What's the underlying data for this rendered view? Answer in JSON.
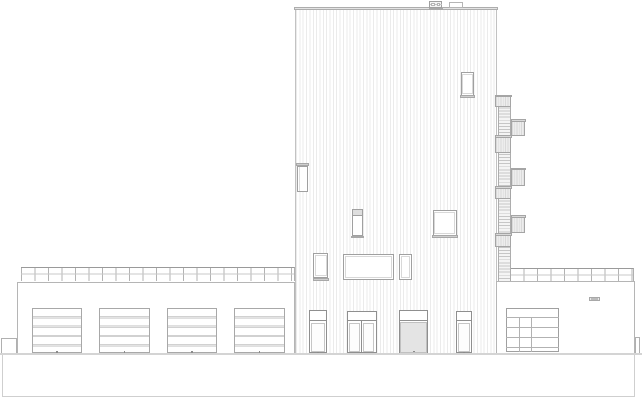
{
  "canvas": {
    "width": 644,
    "height": 400,
    "background": "#ffffff"
  },
  "palette": {
    "frame_dark": "#8f8f8f",
    "frame_mid": "#a8a8a8",
    "line_light": "#c9c9c9",
    "cladding_line": "#ebebeb",
    "panel_fill": "#ededed",
    "ground_line": "#d4d4d4",
    "basement_line": "#cfcfcf",
    "paper": "#ffffff"
  },
  "elements": [
    {
      "name": "tower-facade",
      "cls": "cladding",
      "x": 294.5,
      "y": 10,
      "w": 202.5,
      "h": 343.5
    },
    {
      "name": "tower-parapet-cap",
      "cls": "cap",
      "x": 294,
      "y": 6.6,
      "w": 203.5,
      "h": 3.9
    },
    {
      "name": "roof-unit-base",
      "cls": "sill",
      "x": 428.5,
      "y": 7.6,
      "w": 14.5,
      "h": 2
    },
    {
      "name": "roof-unit",
      "cls": "unit",
      "x": 429,
      "y": 1,
      "w": 13,
      "h": 6.6
    },
    {
      "name": "roof-unit-line",
      "cls": "hline",
      "x": 429.5,
      "y": 3.9,
      "w": 12,
      "h": 0.8
    },
    {
      "name": "roof-unit-box-1",
      "cls": "unit-in",
      "x": 431.3,
      "y": 2.6,
      "w": 4.2,
      "h": 3
    },
    {
      "name": "roof-unit-box-2",
      "cls": "unit-in",
      "x": 436.6,
      "y": 2.6,
      "w": 3.4,
      "h": 3
    },
    {
      "name": "roof-box",
      "cls": "unit2",
      "x": 448.6,
      "y": 2,
      "w": 14.8,
      "h": 5.6
    },
    {
      "name": "window-upper",
      "cls": "win",
      "x": 460.7,
      "y": 72.3,
      "w": 13.6,
      "h": 24
    },
    {
      "name": "window-upper-inner",
      "cls": "win-inner",
      "x": 462.2,
      "y": 74,
      "w": 10.6,
      "h": 19.5
    },
    {
      "name": "window-upper-sill",
      "cls": "sill",
      "x": 460,
      "y": 95.3,
      "w": 15,
      "h": 2.8
    },
    {
      "name": "side-door-canopy",
      "cls": "sill",
      "x": 295.8,
      "y": 163.2,
      "w": 13.4,
      "h": 2.9
    },
    {
      "name": "side-door",
      "cls": "win",
      "x": 297.4,
      "y": 166.1,
      "w": 11,
      "h": 25.6
    },
    {
      "name": "side-door-jamb",
      "cls": "fill-mid",
      "x": 298.6,
      "y": 167.2,
      "w": 1.8,
      "h": 23.4
    },
    {
      "name": "window-mid-small",
      "cls": "win",
      "x": 351.7,
      "y": 209,
      "w": 11.6,
      "h": 26.7
    },
    {
      "name": "window-mid-small-band",
      "cls": "band",
      "x": 352.6,
      "y": 209.9,
      "w": 9.8,
      "h": 6.4
    },
    {
      "name": "window-mid-small-sill",
      "cls": "sill",
      "x": 351,
      "y": 235.5,
      "w": 13,
      "h": 2.6
    },
    {
      "name": "window-mid-square",
      "cls": "win",
      "x": 432.7,
      "y": 210,
      "w": 24,
      "h": 25.5
    },
    {
      "name": "window-mid-square-inner",
      "cls": "win-inner",
      "x": 434.4,
      "y": 211.7,
      "w": 20.6,
      "h": 22
    },
    {
      "name": "window-mid-square-sill",
      "cls": "sill",
      "x": 432,
      "y": 235.3,
      "w": 25.6,
      "h": 2.8
    },
    {
      "name": "window-l1",
      "cls": "win",
      "x": 313.3,
      "y": 253.3,
      "w": 15,
      "h": 24.5
    },
    {
      "name": "window-l1-inner",
      "cls": "win-inner",
      "x": 315,
      "y": 255,
      "w": 11.6,
      "h": 21
    },
    {
      "name": "window-l1-sill",
      "cls": "sill",
      "x": 312.6,
      "y": 277.6,
      "w": 16.4,
      "h": 3
    },
    {
      "name": "window-wide",
      "cls": "win",
      "x": 342.7,
      "y": 254.3,
      "w": 51.6,
      "h": 25.7
    },
    {
      "name": "window-wide-inner",
      "cls": "win-inner",
      "x": 344.6,
      "y": 256.2,
      "w": 47.8,
      "h": 21.9
    },
    {
      "name": "window-l3",
      "cls": "win",
      "x": 399.3,
      "y": 254.3,
      "w": 12.4,
      "h": 25.7
    },
    {
      "name": "window-l3-inner",
      "cls": "win-inner",
      "x": 401,
      "y": 256,
      "w": 9,
      "h": 22.3
    },
    {
      "name": "entry-door-1",
      "cls": "door",
      "x": 309.3,
      "y": 310,
      "w": 17.4,
      "h": 43.4
    },
    {
      "name": "entry-door-1-transom",
      "cls": "dline",
      "x": 309.3,
      "y": 319.8,
      "w": 17.4,
      "h": 1.1
    },
    {
      "name": "entry-door-1-leaf",
      "cls": "leaf",
      "x": 311.2,
      "y": 322.5,
      "w": 13.6,
      "h": 29
    },
    {
      "name": "entry-door-1-handle",
      "cls": "dot",
      "x": 317.3,
      "y": 351.6,
      "w": 1.7,
      "h": 1.5
    },
    {
      "name": "entry-door-2",
      "cls": "door",
      "x": 346.7,
      "y": 310.7,
      "w": 30,
      "h": 42.7
    },
    {
      "name": "entry-door-2-transom",
      "cls": "dline",
      "x": 346.7,
      "y": 320.2,
      "w": 30,
      "h": 1.1
    },
    {
      "name": "entry-door-2-leaf-left",
      "cls": "leaf",
      "x": 348.6,
      "y": 322.6,
      "w": 11.2,
      "h": 29.2
    },
    {
      "name": "entry-door-2-leaf-right",
      "cls": "leaf",
      "x": 363.2,
      "y": 322.6,
      "w": 11.2,
      "h": 29.2
    },
    {
      "name": "entry-door-2-mullion",
      "cls": "dline",
      "x": 360.9,
      "y": 321.3,
      "w": 1.2,
      "h": 32.1
    },
    {
      "name": "entry-door-2-handle",
      "cls": "dot",
      "x": 360.3,
      "y": 351.6,
      "w": 1.7,
      "h": 1.5
    },
    {
      "name": "service-door",
      "cls": "door",
      "x": 399.3,
      "y": 310,
      "w": 29,
      "h": 43.4
    },
    {
      "name": "service-door-transom",
      "cls": "dline",
      "x": 399.3,
      "y": 319.8,
      "w": 29,
      "h": 1.1
    },
    {
      "name": "service-door-panel",
      "cls": "dfill",
      "x": 400.4,
      "y": 321.5,
      "w": 26.8,
      "h": 31.2
    },
    {
      "name": "service-door-handle",
      "cls": "dot",
      "x": 412.7,
      "y": 350.9,
      "w": 2,
      "h": 1.6
    },
    {
      "name": "entry-door-3",
      "cls": "door",
      "x": 455.7,
      "y": 310.7,
      "w": 16,
      "h": 42.7
    },
    {
      "name": "entry-door-3-transom",
      "cls": "dline",
      "x": 455.7,
      "y": 320.2,
      "w": 16,
      "h": 1.1
    },
    {
      "name": "entry-door-3-leaf",
      "cls": "leaf",
      "x": 457.5,
      "y": 322.5,
      "w": 12.4,
      "h": 29.2
    },
    {
      "name": "entry-door-3-handle",
      "cls": "dot",
      "x": 462.9,
      "y": 351.6,
      "w": 1.7,
      "h": 1.5
    },
    {
      "name": "left-wing-facade",
      "cls": "wing",
      "x": 17.3,
      "y": 281.5,
      "w": 278,
      "h": 71.8
    },
    {
      "name": "left-wing-roof-railing",
      "cls": "railing",
      "x": 20.7,
      "y": 267.2,
      "w": 274.6,
      "h": 14.3
    },
    {
      "name": "garage-door-1",
      "cls": "gdoor",
      "x": 31.7,
      "y": 307.7,
      "w": 50.4,
      "h": 45.2
    },
    {
      "name": "garage-door-2",
      "cls": "gdoor",
      "x": 99.3,
      "y": 307.7,
      "w": 50.4,
      "h": 45.2
    },
    {
      "name": "garage-door-3",
      "cls": "gdoor",
      "x": 166.8,
      "y": 307.7,
      "w": 50.4,
      "h": 45.2
    },
    {
      "name": "garage-door-4",
      "cls": "gdoor",
      "x": 234.2,
      "y": 307.7,
      "w": 50.4,
      "h": 45.2
    },
    {
      "name": "garage-door-1-handle",
      "cls": "dot",
      "x": 56.2,
      "y": 351.3,
      "w": 1.7,
      "h": 1.5
    },
    {
      "name": "garage-door-2-handle",
      "cls": "dot",
      "x": 123.7,
      "y": 351.3,
      "w": 1.7,
      "h": 1.5
    },
    {
      "name": "garage-door-3-handle",
      "cls": "dot",
      "x": 191.2,
      "y": 351.3,
      "w": 1.7,
      "h": 1.5
    },
    {
      "name": "garage-door-4-handle",
      "cls": "dot",
      "x": 258.6,
      "y": 351.3,
      "w": 1.7,
      "h": 1.5
    },
    {
      "name": "left-ramp-wall",
      "cls": "outline",
      "x": 0.7,
      "y": 338,
      "w": 16.6,
      "h": 15
    },
    {
      "name": "right-wing-facade",
      "cls": "wing",
      "x": 496.2,
      "y": 281,
      "w": 138.6,
      "h": 72.3
    },
    {
      "name": "right-wing-roof-railing",
      "cls": "railing",
      "x": 509.8,
      "y": 268,
      "w": 124.4,
      "h": 13
    },
    {
      "name": "glazed-door",
      "cls": "door2",
      "x": 506,
      "y": 307.7,
      "w": 53,
      "h": 44.6
    },
    {
      "name": "glazed-door-transom-line",
      "cls": "dline-l",
      "x": 506,
      "y": 317.4,
      "w": 53,
      "h": 1
    },
    {
      "name": "glazed-door-rail-1",
      "cls": "dline-l",
      "x": 506,
      "y": 327.3,
      "w": 53,
      "h": 0.9
    },
    {
      "name": "glazed-door-rail-2",
      "cls": "dline-l",
      "x": 506,
      "y": 337.3,
      "w": 53,
      "h": 0.9
    },
    {
      "name": "glazed-door-rail-3",
      "cls": "dline-l",
      "x": 506,
      "y": 347.3,
      "w": 53,
      "h": 0.9
    },
    {
      "name": "glazed-door-mullion-1",
      "cls": "dline-l",
      "x": 519.3,
      "y": 317.4,
      "w": 0.9,
      "h": 34.9
    },
    {
      "name": "glazed-door-mullion-2",
      "cls": "dline-l",
      "x": 530.7,
      "y": 317.4,
      "w": 0.9,
      "h": 34.9
    },
    {
      "name": "wall-vent",
      "cls": "vent",
      "x": 589.3,
      "y": 296.7,
      "w": 10.4,
      "h": 4.6
    },
    {
      "name": "wall-vent-inner",
      "cls": "vent-in",
      "x": 591.3,
      "y": 297.9,
      "w": 6.4,
      "h": 2.2
    },
    {
      "name": "right-stub-wall",
      "cls": "outline",
      "x": 634.8,
      "y": 336.7,
      "w": 5.4,
      "h": 16.3
    },
    {
      "name": "escape-stair-ladder",
      "cls": "ladder",
      "x": 497.8,
      "y": 95,
      "w": 13.4,
      "h": 186
    },
    {
      "name": "stair-landing-a1",
      "cls": "balc",
      "x": 495.4,
      "y": 94.6,
      "w": 16,
      "h": 12.6
    },
    {
      "name": "stair-landing-a1-cap",
      "cls": "cap2",
      "x": 495,
      "y": 94.6,
      "w": 16.8,
      "h": 2.6
    },
    {
      "name": "stair-landing-b1",
      "cls": "balc",
      "x": 511.2,
      "y": 119,
      "w": 13.9,
      "h": 17.2
    },
    {
      "name": "stair-landing-b1-cap",
      "cls": "cap2",
      "x": 511,
      "y": 119,
      "w": 14.6,
      "h": 2.6
    },
    {
      "name": "stair-landing-a2",
      "cls": "balc",
      "x": 495.4,
      "y": 135,
      "w": 16,
      "h": 18.4
    },
    {
      "name": "stair-landing-a2-cap",
      "cls": "cap2",
      "x": 495,
      "y": 135,
      "w": 16.8,
      "h": 2.6
    },
    {
      "name": "stair-landing-b2",
      "cls": "balc",
      "x": 511.2,
      "y": 167.8,
      "w": 13.9,
      "h": 18.4
    },
    {
      "name": "stair-landing-b2-cap",
      "cls": "cap2",
      "x": 511,
      "y": 167.8,
      "w": 14.6,
      "h": 2.6
    },
    {
      "name": "stair-landing-a3",
      "cls": "balc",
      "x": 495.4,
      "y": 186,
      "w": 16,
      "h": 12.6
    },
    {
      "name": "stair-landing-a3-cap",
      "cls": "cap2",
      "x": 495,
      "y": 186,
      "w": 16.8,
      "h": 2.6
    },
    {
      "name": "stair-landing-b3",
      "cls": "balc",
      "x": 511.2,
      "y": 215.2,
      "w": 13.9,
      "h": 18.2
    },
    {
      "name": "stair-landing-b3-cap",
      "cls": "cap2",
      "x": 511,
      "y": 215.2,
      "w": 14.6,
      "h": 2.6
    },
    {
      "name": "stair-landing-a4",
      "cls": "balc",
      "x": 495.4,
      "y": 233.2,
      "w": 16,
      "h": 13.8
    },
    {
      "name": "stair-landing-a4-cap",
      "cls": "cap2",
      "x": 495,
      "y": 233.2,
      "w": 16.8,
      "h": 2.6
    },
    {
      "name": "ground-line",
      "cls": "ground",
      "x": 0,
      "y": 352.8,
      "w": 642,
      "h": 1.8
    },
    {
      "name": "basement-outline-left",
      "cls": "bline",
      "x": 1.8,
      "y": 354.6,
      "w": 0.9,
      "h": 41.8
    },
    {
      "name": "basement-outline-bottom",
      "cls": "bline",
      "x": 1.8,
      "y": 395.8,
      "w": 632.8,
      "h": 0.9
    },
    {
      "name": "basement-outline-right",
      "cls": "bline",
      "x": 633.8,
      "y": 354.6,
      "w": 0.9,
      "h": 41.8
    }
  ]
}
